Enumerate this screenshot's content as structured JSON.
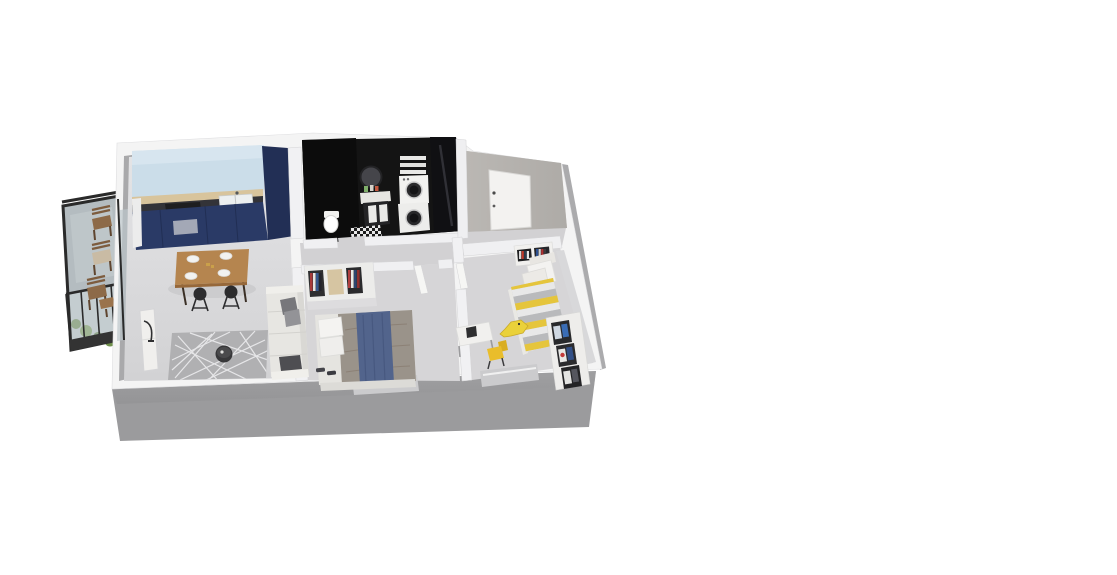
{
  "meta": {
    "title": "3D isometric floor plan render of a one/two-bedroom apartment",
    "render_type": "isometric-floorplan",
    "background": "#ffffff"
  },
  "palette": {
    "outer_wall_top": "#f4f4f4",
    "outer_wall_face": "#9b9b9d",
    "inner_wall": "#f0f0f2",
    "floor_living": "#dcdbdd",
    "floor_bedroom": "#d6d5d7",
    "floor_hall": "#d2d1d3",
    "kitchen_wall": "#cbdde9",
    "kitchen_backsplash": "#d8c49c",
    "kitchen_cabinets": "#2a3a66",
    "counter": "#333338",
    "bathroom_wall": "#141414",
    "rug": "#b0b0b2",
    "sofa": "#e7e6e2",
    "table_wood": "#b5854f",
    "bed1_duvet": "#9a938a",
    "bed1_runner": "#52648c",
    "bed2_yellow": "#e5c53c",
    "accent_yellow": "#e9bd2b",
    "balcony_frame": "#2a2a2a",
    "plant_green": "#5e7c42",
    "door_white": "#f3f2f0",
    "entry_wall": "#b5b2ae"
  },
  "rooms": [
    {
      "id": "balcony",
      "items": [
        "dark metal frame",
        "glass railing panels",
        "three wooden chairs",
        "small wooden side table",
        "planter greenery"
      ]
    },
    {
      "id": "living-room-kitchen",
      "items": [
        "navy kitchen cabinetry",
        "tall navy cabinet",
        "white sink",
        "dark cooktop",
        "wood backsplash strip",
        "light blue splash wall",
        "wooden dining table with four place settings",
        "two dark bar stools",
        "light L-shaped sofa with gray pillows",
        "dark folded blanket",
        "gray rug with white line pattern",
        "round dark coffee table",
        "white tv bench",
        "black floor lamp"
      ]
    },
    {
      "id": "bathroom",
      "items": [
        "black walls",
        "round mirror",
        "vanity with toiletries",
        "white cabinet doors",
        "toilet",
        "stacked washer and dryer",
        "towel shelves",
        "black and white checkered mat"
      ]
    },
    {
      "id": "entry",
      "items": [
        "white front door with dark handle",
        "gray entry wall"
      ]
    },
    {
      "id": "hallway",
      "items": [
        "open white door to bedroom 1",
        "open white door to bedroom 2"
      ]
    },
    {
      "id": "bedroom-1",
      "items": [
        "double bed",
        "gray-taupe duvet",
        "blue runner blanket",
        "two white pillows",
        "open wardrobe with colorful hanging clothes",
        "dark slippers",
        "window in bottom wall"
      ]
    },
    {
      "id": "bedroom-2",
      "items": [
        "single bed with yellow and gray striped duvet",
        "white pillows",
        "white desk with dark computer",
        "yellow desk chair",
        "yellow crocodile plush on floor",
        "white shelf with colorful books",
        "bookcase with posters along right wall",
        "window in bottom wall"
      ]
    }
  ]
}
